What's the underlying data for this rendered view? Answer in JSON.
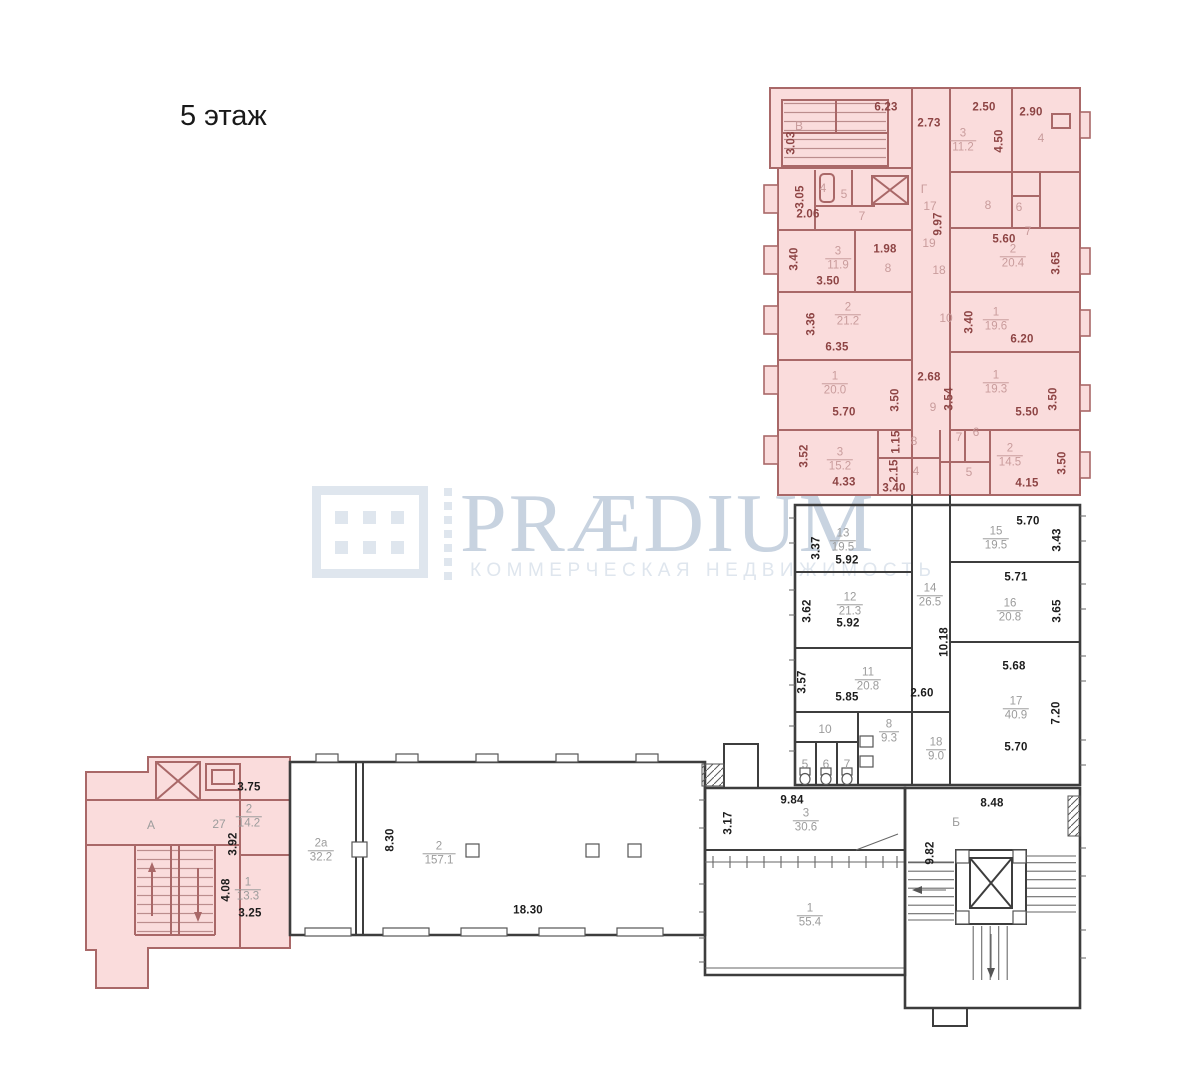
{
  "title": "5 этаж",
  "watermark": {
    "brand": "PRÆDIUM",
    "tagline": "КОММЕРЧЕСКАЯ НЕДВИЖИМОСТЬ"
  },
  "colors": {
    "highlight_fill": "#fadcdc",
    "wall_highlight": "#a96868",
    "dim_highlight": "#8d4444",
    "num_highlight": "#c99c9c",
    "wall_dark": "#3d3d3d",
    "dim_dark": "#1c1c1c",
    "num_gray": "#9c9c9c",
    "logo_main": "#c8d3e0",
    "logo_light": "#dfe6ee"
  },
  "plan": {
    "dimension_labels": [
      {
        "text": "6.23",
        "x": 886,
        "y": 108,
        "zone": "highlight"
      },
      {
        "text": "2.73",
        "x": 929,
        "y": 124,
        "zone": "highlight"
      },
      {
        "text": "2.50",
        "x": 984,
        "y": 108,
        "zone": "highlight"
      },
      {
        "text": "2.90",
        "x": 1031,
        "y": 113,
        "zone": "highlight"
      },
      {
        "text": "3.03",
        "x": 792,
        "y": 143,
        "zone": "highlight",
        "vertical": true
      },
      {
        "text": "4.50",
        "x": 1000,
        "y": 141,
        "zone": "highlight",
        "vertical": true
      },
      {
        "text": "3.05",
        "x": 801,
        "y": 197,
        "zone": "highlight",
        "vertical": true
      },
      {
        "text": "2.06",
        "x": 808,
        "y": 215,
        "zone": "highlight"
      },
      {
        "text": "9.97",
        "x": 939,
        "y": 224,
        "zone": "highlight",
        "vertical": true
      },
      {
        "text": "5.60",
        "x": 1004,
        "y": 240,
        "zone": "highlight"
      },
      {
        "text": "3.65",
        "x": 1057,
        "y": 263,
        "zone": "highlight",
        "vertical": true
      },
      {
        "text": "3.40",
        "x": 795,
        "y": 259,
        "zone": "highlight",
        "vertical": true
      },
      {
        "text": "3.50",
        "x": 828,
        "y": 282,
        "zone": "highlight"
      },
      {
        "text": "1.98",
        "x": 885,
        "y": 250,
        "zone": "highlight"
      },
      {
        "text": "3.36",
        "x": 812,
        "y": 324,
        "zone": "highlight",
        "vertical": true
      },
      {
        "text": "6.35",
        "x": 837,
        "y": 348,
        "zone": "highlight"
      },
      {
        "text": "3.40",
        "x": 970,
        "y": 322,
        "zone": "highlight",
        "vertical": true
      },
      {
        "text": "6.20",
        "x": 1022,
        "y": 340,
        "zone": "highlight"
      },
      {
        "text": "5.70",
        "x": 844,
        "y": 413,
        "zone": "highlight"
      },
      {
        "text": "3.50",
        "x": 896,
        "y": 400,
        "zone": "highlight",
        "vertical": true
      },
      {
        "text": "2.68",
        "x": 929,
        "y": 378,
        "zone": "highlight"
      },
      {
        "text": "3.54",
        "x": 950,
        "y": 399,
        "zone": "highlight",
        "vertical": true
      },
      {
        "text": "5.50",
        "x": 1027,
        "y": 413,
        "zone": "highlight"
      },
      {
        "text": "3.50",
        "x": 1054,
        "y": 399,
        "zone": "highlight",
        "vertical": true
      },
      {
        "text": "3.52",
        "x": 805,
        "y": 456,
        "zone": "highlight",
        "vertical": true
      },
      {
        "text": "4.33",
        "x": 844,
        "y": 483,
        "zone": "highlight"
      },
      {
        "text": "1.15",
        "x": 897,
        "y": 442,
        "zone": "highlight",
        "vertical": true
      },
      {
        "text": "2.15",
        "x": 895,
        "y": 471,
        "zone": "highlight",
        "vertical": true
      },
      {
        "text": "3.40",
        "x": 894,
        "y": 489,
        "zone": "highlight"
      },
      {
        "text": "4.15",
        "x": 1027,
        "y": 484,
        "zone": "highlight"
      },
      {
        "text": "3.50",
        "x": 1063,
        "y": 463,
        "zone": "highlight",
        "vertical": true
      },
      {
        "text": "3.37",
        "x": 817,
        "y": 548,
        "zone": "plain",
        "vertical": true
      },
      {
        "text": "5.92",
        "x": 847,
        "y": 561,
        "zone": "plain"
      },
      {
        "text": "5.70",
        "x": 1028,
        "y": 522,
        "zone": "plain"
      },
      {
        "text": "3.43",
        "x": 1058,
        "y": 540,
        "zone": "plain",
        "vertical": true
      },
      {
        "text": "5.71",
        "x": 1016,
        "y": 578,
        "zone": "plain"
      },
      {
        "text": "3.65",
        "x": 1058,
        "y": 611,
        "zone": "plain",
        "vertical": true
      },
      {
        "text": "3.62",
        "x": 808,
        "y": 611,
        "zone": "plain",
        "vertical": true
      },
      {
        "text": "5.92",
        "x": 848,
        "y": 624,
        "zone": "plain"
      },
      {
        "text": "10.18",
        "x": 945,
        "y": 642,
        "zone": "plain",
        "vertical": true
      },
      {
        "text": "3.57",
        "x": 803,
        "y": 682,
        "zone": "plain",
        "vertical": true
      },
      {
        "text": "5.85",
        "x": 847,
        "y": 698,
        "zone": "plain"
      },
      {
        "text": "2.60",
        "x": 922,
        "y": 694,
        "zone": "plain"
      },
      {
        "text": "5.68",
        "x": 1014,
        "y": 667,
        "zone": "plain"
      },
      {
        "text": "7.20",
        "x": 1057,
        "y": 713,
        "zone": "plain",
        "vertical": true
      },
      {
        "text": "5.70",
        "x": 1016,
        "y": 748,
        "zone": "plain"
      },
      {
        "text": "3.75",
        "x": 249,
        "y": 788,
        "zone": "plain"
      },
      {
        "text": "3.92",
        "x": 234,
        "y": 844,
        "zone": "plain",
        "vertical": true
      },
      {
        "text": "4.08",
        "x": 227,
        "y": 890,
        "zone": "plain",
        "vertical": true
      },
      {
        "text": "3.25",
        "x": 250,
        "y": 914,
        "zone": "plain"
      },
      {
        "text": "8.30",
        "x": 391,
        "y": 840,
        "zone": "plain",
        "vertical": true
      },
      {
        "text": "18.30",
        "x": 528,
        "y": 911,
        "zone": "plain"
      },
      {
        "text": "9.84",
        "x": 792,
        "y": 801,
        "zone": "plain"
      },
      {
        "text": "3.17",
        "x": 729,
        "y": 823,
        "zone": "plain",
        "vertical": true
      },
      {
        "text": "9.82",
        "x": 931,
        "y": 853,
        "zone": "plain",
        "vertical": true
      },
      {
        "text": "8.48",
        "x": 992,
        "y": 804,
        "zone": "plain"
      }
    ],
    "room_numbers": [
      {
        "text": "В",
        "x": 799,
        "y": 126,
        "zone": "highlight"
      },
      {
        "text": "4",
        "x": 1041,
        "y": 138,
        "zone": "highlight"
      },
      {
        "text": "4",
        "x": 823,
        "y": 188,
        "zone": "highlight"
      },
      {
        "text": "5",
        "x": 844,
        "y": 194,
        "zone": "highlight"
      },
      {
        "text": "7",
        "x": 862,
        "y": 216,
        "zone": "highlight"
      },
      {
        "text": "Г",
        "x": 924,
        "y": 189,
        "zone": "highlight"
      },
      {
        "text": "17",
        "x": 930,
        "y": 206,
        "zone": "highlight"
      },
      {
        "text": "8",
        "x": 988,
        "y": 205,
        "zone": "highlight"
      },
      {
        "text": "6",
        "x": 1019,
        "y": 207,
        "zone": "highlight"
      },
      {
        "text": "7",
        "x": 1028,
        "y": 231,
        "zone": "highlight"
      },
      {
        "text": "19",
        "x": 929,
        "y": 243,
        "zone": "highlight"
      },
      {
        "text": "18",
        "x": 939,
        "y": 270,
        "zone": "highlight"
      },
      {
        "text": "8",
        "x": 888,
        "y": 268,
        "zone": "highlight"
      },
      {
        "text": "10",
        "x": 946,
        "y": 318,
        "zone": "highlight"
      },
      {
        "text": "9",
        "x": 933,
        "y": 407,
        "zone": "highlight"
      },
      {
        "text": "8",
        "x": 914,
        "y": 441,
        "zone": "highlight"
      },
      {
        "text": "7",
        "x": 959,
        "y": 437,
        "zone": "highlight"
      },
      {
        "text": "6",
        "x": 976,
        "y": 432,
        "zone": "highlight"
      },
      {
        "text": "4",
        "x": 916,
        "y": 471,
        "zone": "highlight"
      },
      {
        "text": "5",
        "x": 969,
        "y": 472,
        "zone": "highlight"
      },
      {
        "text": "А",
        "x": 151,
        "y": 825,
        "zone": "plain"
      },
      {
        "text": "27",
        "x": 219,
        "y": 824,
        "zone": "plain"
      },
      {
        "text": "10",
        "x": 825,
        "y": 729,
        "zone": "plain"
      },
      {
        "text": "5",
        "x": 805,
        "y": 764,
        "zone": "plain"
      },
      {
        "text": "6",
        "x": 826,
        "y": 764,
        "zone": "plain"
      },
      {
        "text": "7",
        "x": 847,
        "y": 764,
        "zone": "plain"
      },
      {
        "text": "Б",
        "x": 956,
        "y": 822,
        "zone": "plain"
      }
    ],
    "room_areas": [
      {
        "room": "3",
        "area": "11.2",
        "x": 963,
        "y": 141,
        "zone": "highlight"
      },
      {
        "room": "3",
        "area": "11.9",
        "x": 838,
        "y": 259,
        "zone": "highlight"
      },
      {
        "room": "2",
        "area": "20.4",
        "x": 1013,
        "y": 257,
        "zone": "highlight"
      },
      {
        "room": "2",
        "area": "21.2",
        "x": 848,
        "y": 315,
        "zone": "highlight"
      },
      {
        "room": "1",
        "area": "19.6",
        "x": 996,
        "y": 320,
        "zone": "highlight"
      },
      {
        "room": "1",
        "area": "20.0",
        "x": 835,
        "y": 384,
        "zone": "highlight"
      },
      {
        "room": "1",
        "area": "19.3",
        "x": 996,
        "y": 383,
        "zone": "highlight"
      },
      {
        "room": "3",
        "area": "15.2",
        "x": 840,
        "y": 460,
        "zone": "highlight"
      },
      {
        "room": "2",
        "area": "14.5",
        "x": 1010,
        "y": 456,
        "zone": "highlight"
      },
      {
        "room": "2",
        "area": "14.2",
        "x": 249,
        "y": 817,
        "zone": "plain"
      },
      {
        "room": "1",
        "area": "13.3",
        "x": 248,
        "y": 890,
        "zone": "plain"
      },
      {
        "room": "13",
        "area": "19.5",
        "x": 843,
        "y": 541,
        "zone": "plain"
      },
      {
        "room": "15",
        "area": "19.5",
        "x": 996,
        "y": 539,
        "zone": "plain"
      },
      {
        "room": "14",
        "area": "26.5",
        "x": 930,
        "y": 596,
        "zone": "plain"
      },
      {
        "room": "12",
        "area": "21.3",
        "x": 850,
        "y": 605,
        "zone": "plain"
      },
      {
        "room": "16",
        "area": "20.8",
        "x": 1010,
        "y": 611,
        "zone": "plain"
      },
      {
        "room": "11",
        "area": "20.8",
        "x": 868,
        "y": 680,
        "zone": "plain"
      },
      {
        "room": "17",
        "area": "40.9",
        "x": 1016,
        "y": 709,
        "zone": "plain"
      },
      {
        "room": "8",
        "area": "9.3",
        "x": 889,
        "y": 732,
        "zone": "plain"
      },
      {
        "room": "18",
        "area": "9.0",
        "x": 936,
        "y": 750,
        "zone": "plain"
      },
      {
        "room": "2а",
        "area": "32.2",
        "x": 321,
        "y": 851,
        "zone": "plain"
      },
      {
        "room": "2",
        "area": "157.1",
        "x": 439,
        "y": 854,
        "zone": "plain"
      },
      {
        "room": "3",
        "area": "30.6",
        "x": 806,
        "y": 821,
        "zone": "plain"
      },
      {
        "room": "1",
        "area": "55.4",
        "x": 810,
        "y": 916,
        "zone": "plain"
      }
    ]
  }
}
